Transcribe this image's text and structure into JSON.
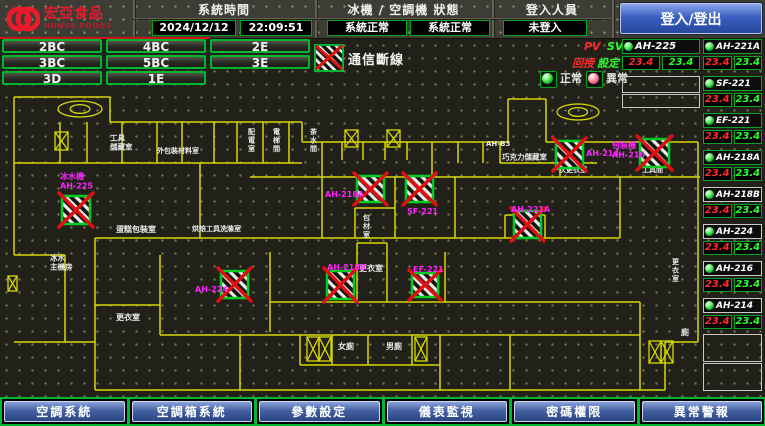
{
  "colors": {
    "accent_green": "#00b530",
    "alarm_red": "#e01010",
    "label_magenta": "#ff22ff",
    "wall_yellow": "#d8d800",
    "nav_blue": "#44609f",
    "pv_red": "#ff2a2a",
    "sv_green": "#2aff2a"
  },
  "header": {
    "logo_line1": "宏亞食品",
    "logo_line2": "HUNYA FOODS",
    "system_time_label": "系統時間",
    "date_value": "2024/12/12",
    "time_value": "22:09:51",
    "status_label": "冰機 / 空調機 狀態",
    "chiller_status": "系統正常",
    "ac_status": "系統正常",
    "login_label": "登入人員",
    "login_status": "未登入",
    "login_button": "登入/登出"
  },
  "floor_buttons": [
    [
      "2BC",
      "4BC",
      "2E"
    ],
    [
      "3BC",
      "5BC",
      "3E"
    ],
    [
      "3D",
      "1E"
    ]
  ],
  "legend": {
    "disconnect": "通信斷線",
    "normal": "正常",
    "abnormal": "異常",
    "pv": "PV",
    "sv": "SV",
    "feedback": "回授",
    "setpoint": "設定"
  },
  "equipment_left": [
    {
      "name": "AH-225",
      "pv": "23.4",
      "sv": "23.4",
      "box": "green",
      "status": "normal"
    }
  ],
  "equipment_right": [
    {
      "name": "AH-221A",
      "pv": "23.4",
      "sv": "23.4",
      "box": "green",
      "status": "normal"
    },
    {
      "name": "SF-221",
      "pv": "23.4",
      "sv": "23.4",
      "box": "green",
      "status": "normal"
    },
    {
      "name": "EF-221",
      "pv": "23.4",
      "sv": "23.4",
      "box": "green",
      "status": "normal"
    },
    {
      "name": "AH-218A",
      "pv": "23.4",
      "sv": "23.4",
      "box": "green",
      "status": "normal"
    },
    {
      "name": "AH-218B",
      "pv": "23.4",
      "sv": "23.4",
      "box": "white",
      "status": "normal"
    },
    {
      "name": "AH-224",
      "pv": "23.4",
      "sv": "23.4",
      "box": "white",
      "status": "normal"
    },
    {
      "name": "AH-216",
      "pv": "23.4",
      "sv": "23.4",
      "box": "white",
      "status": "normal"
    },
    {
      "name": "AH-214",
      "pv": "23.4",
      "sv": "23.4",
      "box": "white",
      "status": "normal"
    }
  ],
  "nav_buttons": [
    "空調系統",
    "空調箱系統",
    "參數設定",
    "儀表監視",
    "密碼權限",
    "異常警報"
  ],
  "floorplan": {
    "walls": [
      [
        14,
        97,
        110,
        97
      ],
      [
        14,
        97,
        14,
        255
      ],
      [
        110,
        97,
        110,
        122
      ],
      [
        110,
        122,
        302,
        122
      ],
      [
        302,
        122,
        302,
        142
      ],
      [
        302,
        142,
        508,
        142
      ],
      [
        508,
        142,
        508,
        99
      ],
      [
        508,
        99,
        546,
        99
      ],
      [
        546,
        99,
        546,
        142
      ],
      [
        546,
        142,
        698,
        142
      ],
      [
        698,
        142,
        698,
        342
      ],
      [
        60,
        122,
        60,
        163
      ],
      [
        14,
        163,
        302,
        163
      ],
      [
        87,
        122,
        87,
        163
      ],
      [
        122,
        122,
        122,
        163
      ],
      [
        157,
        122,
        157,
        163
      ],
      [
        182,
        122,
        182,
        163
      ],
      [
        214,
        122,
        214,
        163
      ],
      [
        237,
        122,
        237,
        163
      ],
      [
        263,
        122,
        263,
        163
      ],
      [
        289,
        122,
        289,
        163
      ],
      [
        322,
        142,
        322,
        177
      ],
      [
        342,
        142,
        342,
        160
      ],
      [
        363,
        142,
        363,
        160
      ],
      [
        385,
        142,
        385,
        160
      ],
      [
        407,
        142,
        407,
        160
      ],
      [
        432,
        142,
        432,
        177
      ],
      [
        458,
        142,
        458,
        163
      ],
      [
        483,
        142,
        483,
        163
      ],
      [
        250,
        177,
        700,
        177
      ],
      [
        200,
        163,
        200,
        238
      ],
      [
        95,
        238,
        455,
        238
      ],
      [
        455,
        177,
        455,
        238
      ],
      [
        322,
        177,
        322,
        238
      ],
      [
        395,
        177,
        395,
        238
      ],
      [
        355,
        208,
        395,
        208
      ],
      [
        355,
        208,
        355,
        238
      ],
      [
        500,
        142,
        500,
        163
      ],
      [
        500,
        163,
        597,
        163
      ],
      [
        560,
        163,
        560,
        177
      ],
      [
        505,
        215,
        545,
        215
      ],
      [
        505,
        215,
        505,
        238
      ],
      [
        545,
        215,
        545,
        238
      ],
      [
        455,
        238,
        620,
        238
      ],
      [
        620,
        177,
        620,
        238
      ],
      [
        14,
        255,
        65,
        255
      ],
      [
        65,
        255,
        65,
        342
      ],
      [
        14,
        342,
        65,
        342
      ],
      [
        65,
        342,
        95,
        342
      ],
      [
        95,
        238,
        95,
        390
      ],
      [
        95,
        390,
        665,
        390
      ],
      [
        665,
        390,
        665,
        342
      ],
      [
        665,
        342,
        698,
        342
      ],
      [
        160,
        255,
        160,
        335
      ],
      [
        95,
        305,
        160,
        305
      ],
      [
        270,
        252,
        270,
        332
      ],
      [
        357,
        243,
        357,
        302
      ],
      [
        387,
        243,
        387,
        302
      ],
      [
        357,
        243,
        387,
        243
      ],
      [
        270,
        302,
        640,
        302
      ],
      [
        445,
        252,
        445,
        302
      ],
      [
        160,
        335,
        640,
        335
      ],
      [
        240,
        335,
        240,
        390
      ],
      [
        300,
        335,
        300,
        365
      ],
      [
        332,
        335,
        332,
        365
      ],
      [
        368,
        335,
        368,
        365
      ],
      [
        412,
        335,
        412,
        365
      ],
      [
        300,
        365,
        440,
        365
      ],
      [
        440,
        335,
        440,
        390
      ],
      [
        510,
        335,
        510,
        390
      ],
      [
        640,
        302,
        640,
        390
      ]
    ],
    "stairs": [
      [
        55,
        132,
        13,
        18
      ],
      [
        345,
        130,
        13,
        17
      ],
      [
        387,
        130,
        13,
        17
      ],
      [
        307,
        337,
        12,
        24
      ],
      [
        319,
        337,
        12,
        24
      ],
      [
        415,
        337,
        12,
        24
      ],
      [
        649,
        341,
        12,
        22
      ],
      [
        661,
        341,
        12,
        22
      ],
      [
        8,
        276,
        9,
        15
      ]
    ],
    "coils": [
      [
        80,
        109,
        22,
        8
      ],
      [
        578,
        112,
        21,
        8
      ]
    ],
    "rooms": [
      {
        "t": "工具\n儲藏室",
        "x": 110,
        "y": 133,
        "s": 7.5
      },
      {
        "t": "外包裝材料室",
        "x": 157,
        "y": 146,
        "s": 7
      },
      {
        "t": "配電室",
        "x": 248,
        "y": 127,
        "v": 1,
        "s": 7
      },
      {
        "t": "電梯間",
        "x": 273,
        "y": 127,
        "v": 1,
        "s": 7
      },
      {
        "t": "茶水間",
        "x": 310,
        "y": 127,
        "v": 1,
        "s": 7
      },
      {
        "t": "AH-B3",
        "x": 486,
        "y": 139,
        "s": 7
      },
      {
        "t": "巧克力儲藏室",
        "x": 502,
        "y": 152,
        "s": 7.5
      },
      {
        "t": "一次更衣室",
        "x": 552,
        "y": 165,
        "s": 7
      },
      {
        "t": "工具間",
        "x": 642,
        "y": 165,
        "s": 7
      },
      {
        "t": "包材室",
        "x": 363,
        "y": 213,
        "v": 1,
        "s": 7
      },
      {
        "t": "蛋糕包裝室",
        "x": 116,
        "y": 224,
        "s": 8
      },
      {
        "t": "烘焙工具洗滌室",
        "x": 192,
        "y": 224,
        "s": 7
      },
      {
        "t": "冰水\n主機房",
        "x": 50,
        "y": 253,
        "s": 7.5
      },
      {
        "t": "更衣室",
        "x": 116,
        "y": 312,
        "s": 8
      },
      {
        "t": "更衣室",
        "x": 359,
        "y": 263,
        "s": 8
      },
      {
        "t": "女廁",
        "x": 338,
        "y": 341,
        "s": 8
      },
      {
        "t": "男廁",
        "x": 386,
        "y": 341,
        "s": 8
      },
      {
        "t": "更衣室",
        "x": 672,
        "y": 257,
        "v": 1,
        "s": 7
      },
      {
        "t": "廁",
        "x": 681,
        "y": 327,
        "s": 8
      }
    ],
    "devices": [
      {
        "l": "冰水機\nAH-225",
        "lx": 60,
        "ly": 171,
        "mx": 62,
        "my": 196,
        "mw": 28,
        "mh": 28
      },
      {
        "l": "AH-218A",
        "lx": 325,
        "ly": 189,
        "mx": 357,
        "my": 176,
        "mw": 27,
        "mh": 26
      },
      {
        "l": "SF-221",
        "lx": 407,
        "ly": 206,
        "mx": 406,
        "my": 176,
        "mw": 27,
        "mh": 26
      },
      {
        "l": "AH-214",
        "lx": 586,
        "ly": 148,
        "mx": 556,
        "my": 141,
        "mw": 27,
        "mh": 27
      },
      {
        "l": "包裝機\nAH-216",
        "lx": 612,
        "ly": 140,
        "mx": 640,
        "my": 139,
        "mw": 29,
        "mh": 28
      },
      {
        "l": "AH-221A",
        "lx": 511,
        "ly": 204,
        "mx": 514,
        "my": 211,
        "mw": 27,
        "mh": 27
      },
      {
        "l": "AH-218B",
        "lx": 327,
        "ly": 262,
        "mx": 327,
        "my": 271,
        "mw": 27,
        "mh": 28
      },
      {
        "l": "EF-221",
        "lx": 413,
        "ly": 264,
        "mx": 412,
        "my": 273,
        "mw": 26,
        "mh": 24
      },
      {
        "l": "AH-224",
        "lx": 195,
        "ly": 284,
        "mx": 221,
        "my": 271,
        "mw": 27,
        "mh": 27
      }
    ]
  }
}
